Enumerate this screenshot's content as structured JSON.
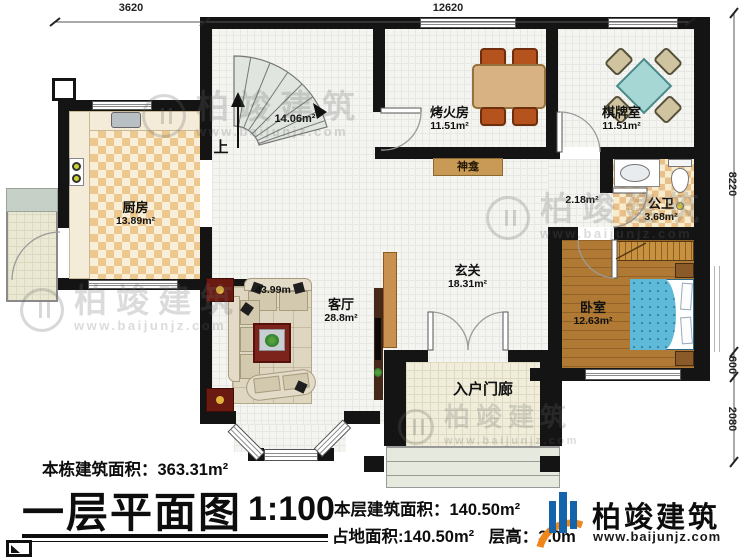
{
  "dimensions": {
    "top": [
      "3620",
      "12620"
    ],
    "right": [
      "8220",
      "600",
      "2080"
    ]
  },
  "rooms": {
    "kitchen": {
      "name": "厨房",
      "area": "13.89m²"
    },
    "stairwell": {
      "area": "14.06m²",
      "direction": "上"
    },
    "fire_room": {
      "name": "烤火房",
      "area": "11.51m²"
    },
    "chess_room": {
      "name": "棋牌室",
      "area": "11.51m²"
    },
    "shrine": {
      "label": "神龛"
    },
    "hallway": {
      "area": "2.18m²"
    },
    "bathroom": {
      "name": "公卫",
      "area": "3.68m²"
    },
    "foyer": {
      "name": "玄关",
      "area": "18.31m²"
    },
    "living_room": {
      "name": "客厅",
      "area": "28.8m²",
      "extra_label": "43.99m"
    },
    "bedroom": {
      "name": "卧室",
      "area": "12.63m²"
    },
    "entry_porch": {
      "name": "入户门廊"
    }
  },
  "footer": {
    "building_total_area": "本栋建筑面积：363.31m²",
    "plan_title": "一层平面图",
    "scale": "1:100",
    "floor_area": "本层建筑面积：140.50m²",
    "land_area": "占地面积:140.50m²",
    "floor_height": "层高：3.0m"
  },
  "brand": {
    "name": "柏竣建筑",
    "website": "www.baijunjz.com"
  },
  "watermark": {
    "name": "柏竣建筑",
    "website": "www.baijunjz.com"
  },
  "colors": {
    "wall": "#141414",
    "brand_blue": "#1464ac",
    "brand_orange": "#f08519",
    "bed_blue": "#5fb9d8",
    "floor_tan": "#ecc78e"
  }
}
